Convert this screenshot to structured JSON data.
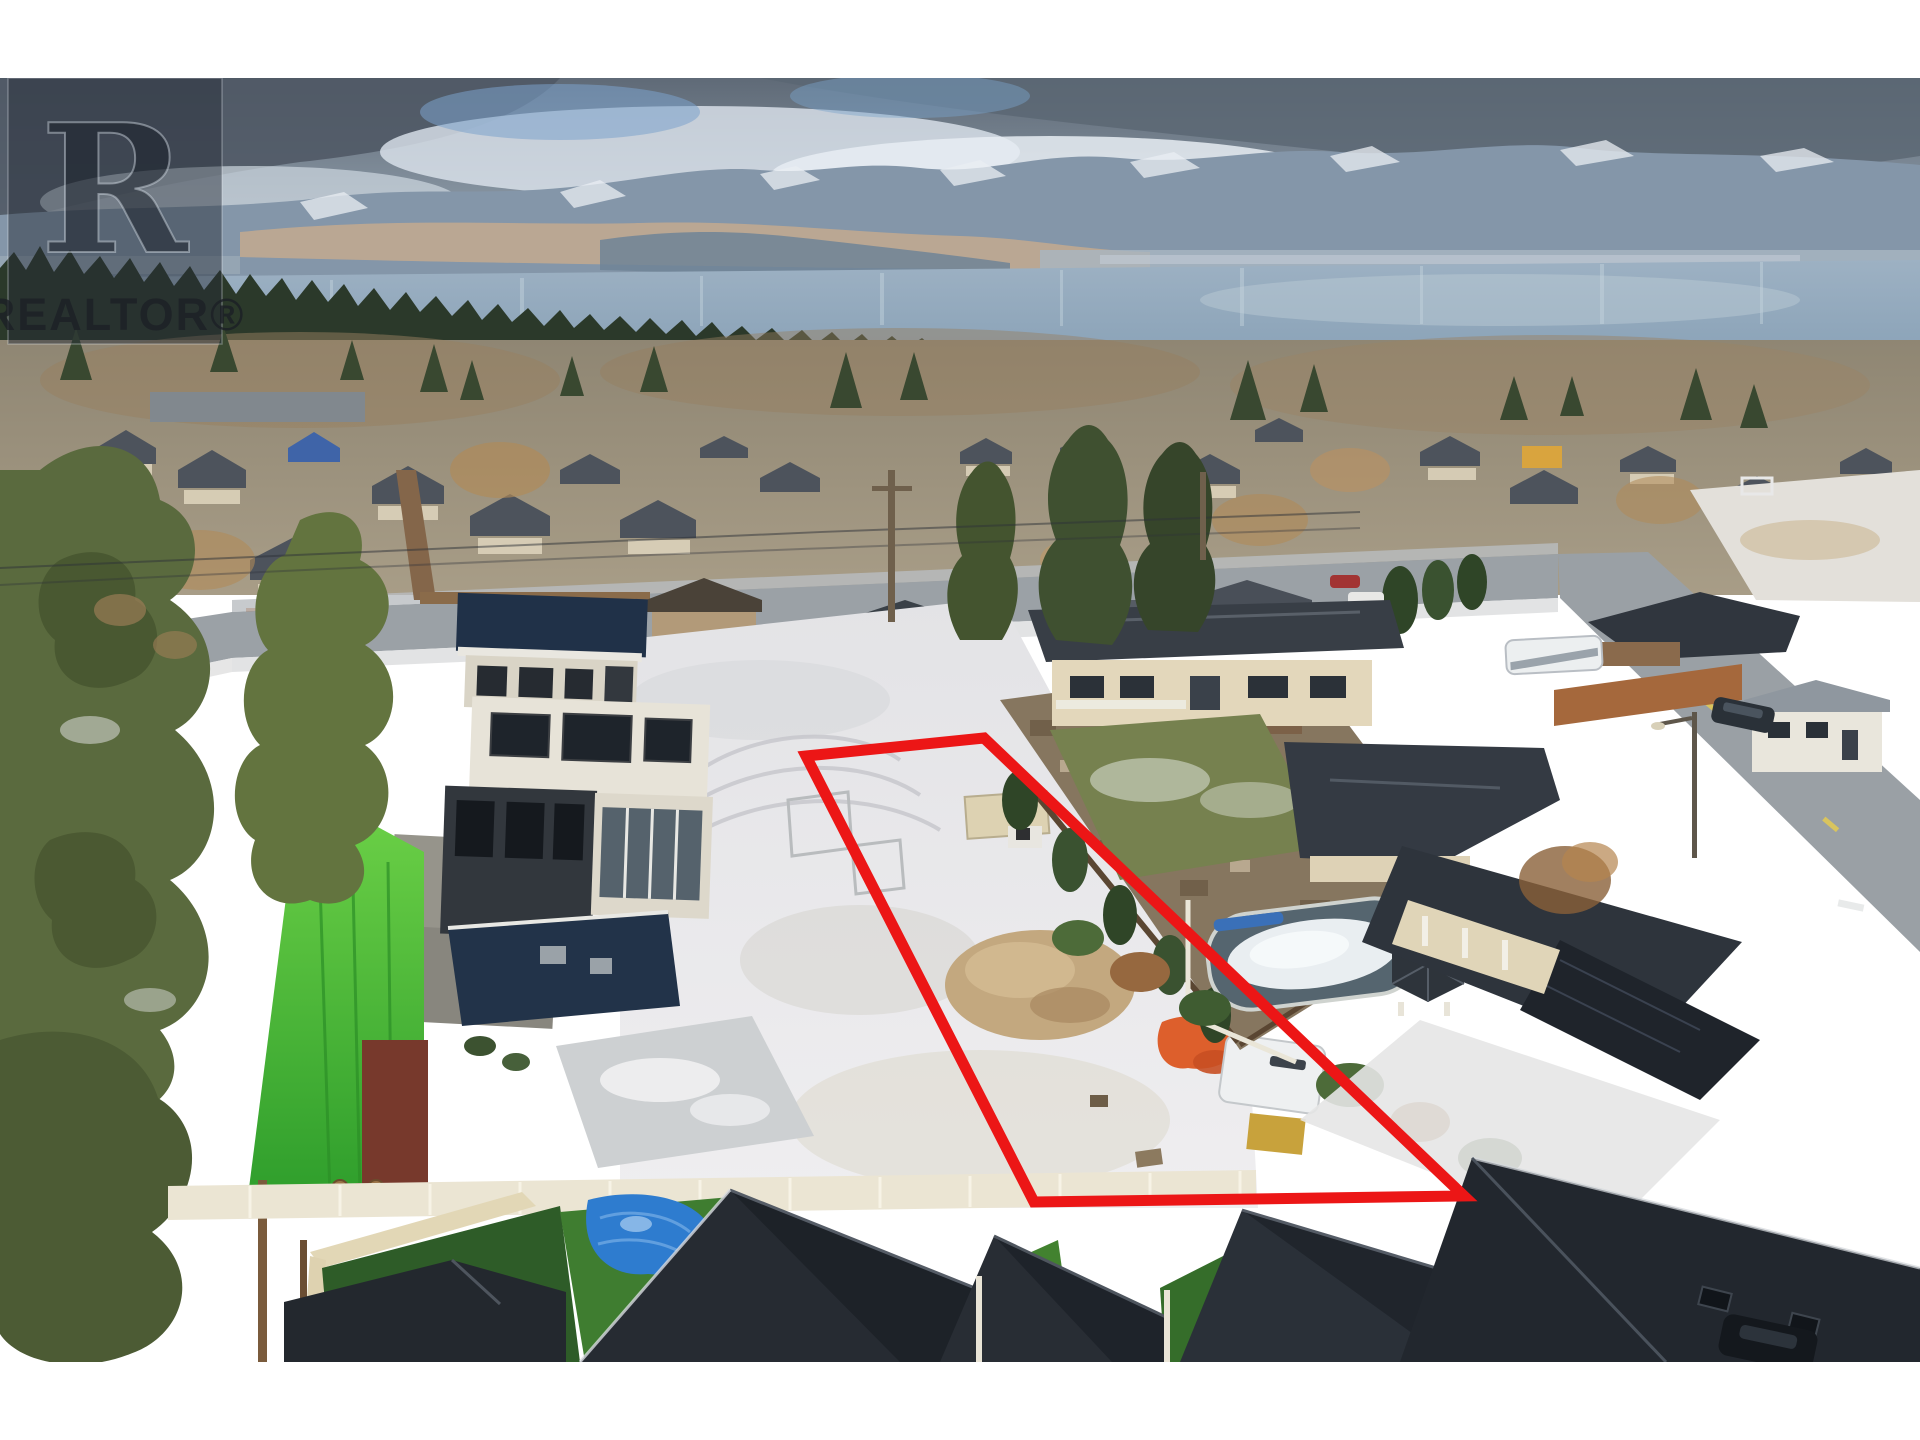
{
  "watermark": {
    "monogram": "R",
    "label": "REALTOR®"
  },
  "boundary": {
    "color": "#ec1616",
    "vertices": "806,756 984,738 1464,1196 1034,1202"
  },
  "palette": {
    "sky_top": "#5f6a77",
    "cloud_dark": "#4e5864",
    "cloud_bright": "#e3eaf1",
    "mountain": "#8496a9",
    "mountain_snow": "#e9eef3",
    "sunlit_slope": "#c8ab8d",
    "lake": "#93a9bd",
    "treeline": "#2b392a",
    "snow_lot": "#e9e9eb",
    "asphalt": "#9ba1a6",
    "roof_charcoal": "#23282e",
    "roof_navy": "#223349",
    "lime_roof": "#55c33c",
    "turf_green": "#3f7d30",
    "tarp_blue": "#2e7ccf",
    "tarp_orange": "#dd5f2c",
    "gravel_pile": "#c3a87f",
    "fence_white": "#ebe5d3",
    "beige_wall": "#e3d7bb"
  }
}
